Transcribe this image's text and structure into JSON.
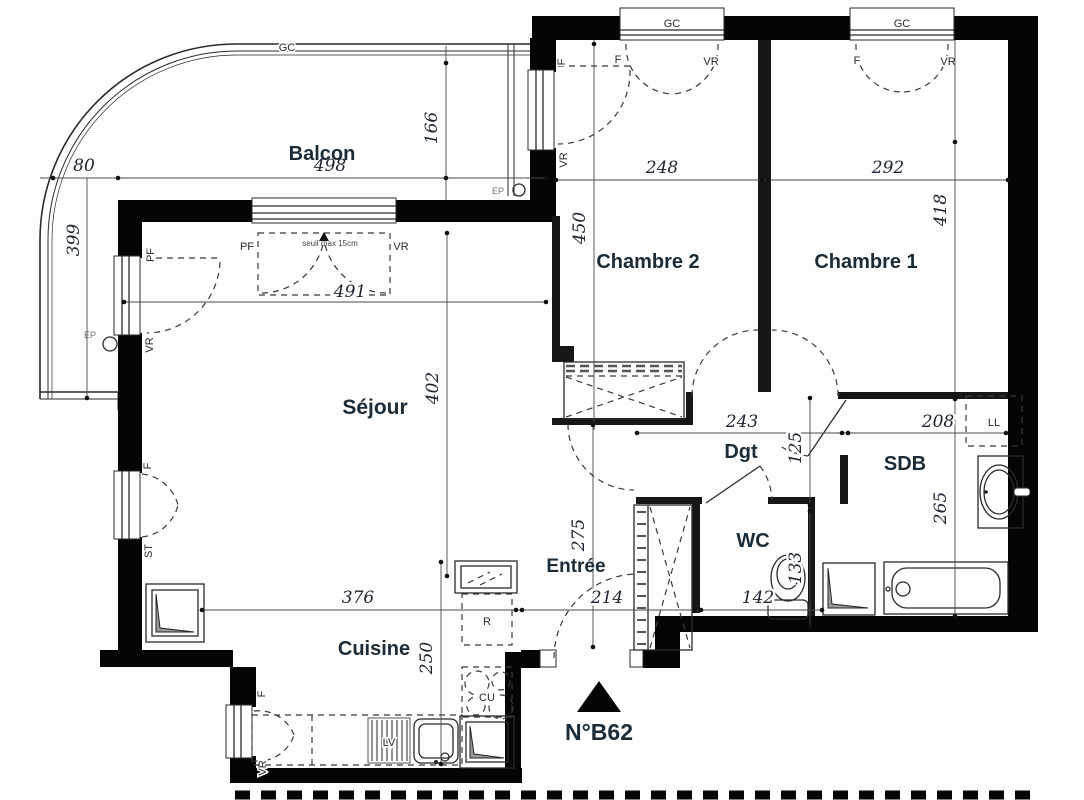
{
  "unit_label": "N°B62",
  "rooms": {
    "balcon": "Balcon",
    "sejour": "Séjour",
    "cuisine": "Cuisine",
    "entree": "Entrée",
    "chambre2": "Chambre 2",
    "chambre1": "Chambre 1",
    "degagement": "Dgt",
    "wc": "WC",
    "sdb": "SDB"
  },
  "dims": {
    "d80": "80",
    "d498": "498",
    "d399": "399",
    "d166": "166",
    "d450": "450",
    "d248": "248",
    "d292": "292",
    "d418": "418",
    "d491": "491",
    "d402": "402",
    "d243": "243",
    "d208": "208",
    "d125": "125",
    "d133": "133",
    "d265": "265",
    "d376": "376",
    "d214": "214",
    "d142": "142",
    "d275": "275",
    "d250": "250"
  },
  "tags": {
    "gc": "GC",
    "f": "F",
    "vr": "VR",
    "pf": "PF",
    "st": "ST",
    "ep": "EP",
    "ll": "LL",
    "lv": "LV",
    "cu": "CU",
    "fridge": "R",
    "seuil": "seuil max 15cm"
  },
  "colors": {
    "wall": "#050505",
    "label_text": "#1c2b38",
    "dimension_text": "#1b2430",
    "background": "#fdfdfd"
  }
}
